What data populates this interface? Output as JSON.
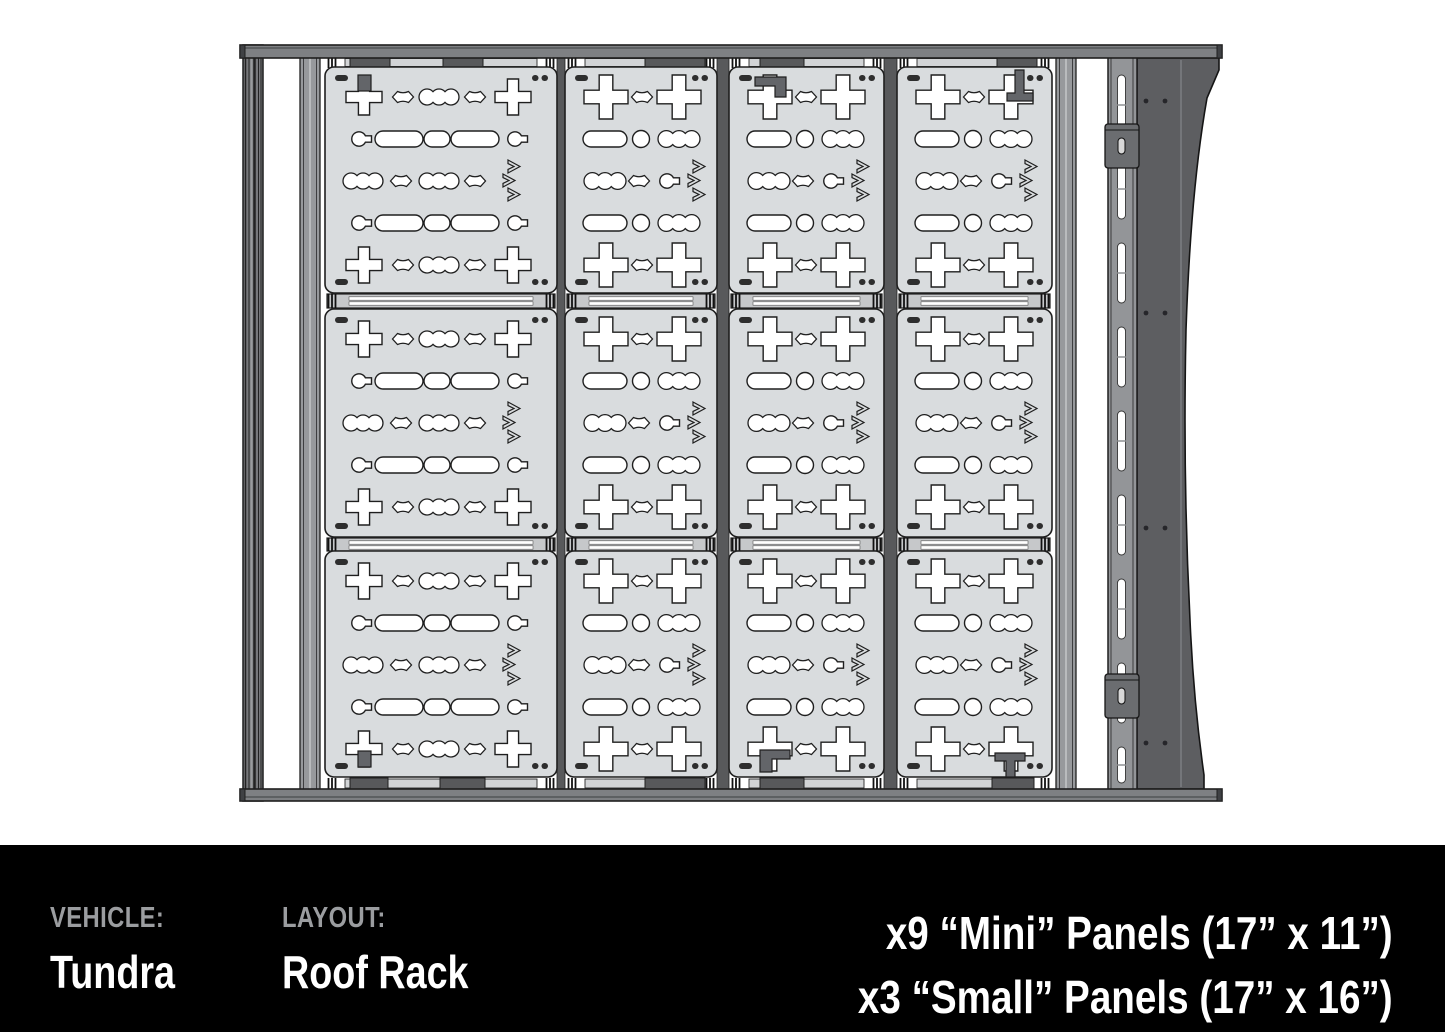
{
  "footer": {
    "vehicle_label": "VEHICLE:",
    "vehicle_value": "Tundra",
    "layout_label": "LAYOUT:",
    "layout_value": "Roof Rack",
    "panels_line1": "x9 “Mini” Panels (17” x 11”)",
    "panels_line2": "x3 “Small” Panels (17” x 16”)",
    "label_color": "#9b9da0",
    "value_color": "#ffffff",
    "bg_color": "#000000"
  },
  "diagram": {
    "canvas": {
      "w": 1445,
      "h": 845
    },
    "colors": {
      "ink": "#1f1f1f",
      "panel": "#d9dcde",
      "frame": "#7e8083",
      "frame_cap": "#3f4144",
      "rail": "#97999c",
      "outer_rail": "#77787b",
      "gap": "#58595b",
      "band": "#c6c8ca",
      "strip": "#d2d4d6",
      "slot_rail": "#939598",
      "fairing": "#5d5e61",
      "clamp": "#6b6d70",
      "bracket": "#636569",
      "screw": "#2e2e2e",
      "white": "#ffffff"
    },
    "top_bar": {
      "x": 240,
      "y": 45,
      "w": 982,
      "h": 13
    },
    "bottom_bar": {
      "x": 240,
      "y": 789,
      "w": 982,
      "h": 12
    },
    "outer_rail": {
      "x": 243,
      "y": 45,
      "w": 20,
      "h": 756
    },
    "inner_rails": [
      {
        "x": 300,
        "y": 57,
        "w": 20,
        "h": 733
      },
      {
        "x": 1056,
        "y": 57,
        "w": 20,
        "h": 733
      }
    ],
    "gap_strips": [
      {
        "x": 557,
        "w": 8
      },
      {
        "x": 717,
        "w": 12
      },
      {
        "x": 884,
        "w": 13
      }
    ],
    "gap_y": {
      "y": 58,
      "h": 731
    },
    "slotted_rail": {
      "x": 1108,
      "y": 57,
      "w": 29,
      "h": 733,
      "slot_x": 1117.5,
      "slot_w": 8,
      "slot_h": 60,
      "pitch": 84,
      "start": 75,
      "end": 783
    },
    "clamps": [
      {
        "x": 1105,
        "y": 124,
        "w": 34,
        "h": 44
      },
      {
        "x": 1105,
        "y": 674,
        "w": 34,
        "h": 44
      }
    ],
    "fairing": {
      "path": "M1137,58 L1219,58 L1219,70 L1207,98 C1196,160 1189,240 1186,330 C1184,420 1185,520 1190,620 C1193,690 1199,740 1204,775 L1204,789 L1137,789 Z",
      "fold_x": 1181,
      "holes": [
        [
          1146,
          101
        ],
        [
          1165,
          101
        ],
        [
          1146,
          313
        ],
        [
          1165,
          313
        ],
        [
          1146,
          528
        ],
        [
          1165,
          528
        ],
        [
          1146,
          743
        ],
        [
          1165,
          743
        ]
      ]
    },
    "columns": [
      {
        "x": 325,
        "w": 232,
        "type": "small"
      },
      {
        "x": 565,
        "w": 152,
        "type": "mini"
      },
      {
        "x": 729,
        "w": 155,
        "type": "mini"
      },
      {
        "x": 897,
        "w": 155,
        "type": "mini"
      }
    ],
    "rows": [
      {
        "y": 67,
        "h": 226
      },
      {
        "y": 309,
        "h": 228
      },
      {
        "y": 551,
        "h": 226
      }
    ],
    "bands": [
      {
        "y": 294,
        "h": 14
      },
      {
        "y": 538,
        "h": 13
      }
    ],
    "strips": [
      {
        "y": 58.5,
        "h": 8
      },
      {
        "y": 779,
        "h": 9
      }
    ],
    "top_tabs": [
      {
        "col": 0,
        "x": 25,
        "w": 40
      },
      {
        "col": 0,
        "x": 118,
        "w": 40
      },
      {
        "col": 1,
        "x": 80,
        "w": 60
      },
      {
        "col": 2,
        "x": 31,
        "w": 44
      },
      {
        "col": 3,
        "x": 100,
        "w": 40
      }
    ],
    "bottom_tabs": [
      {
        "col": 0,
        "x": 25,
        "w": 38
      },
      {
        "col": 0,
        "x": 115,
        "w": 45
      },
      {
        "col": 1,
        "x": 80,
        "w": 60
      },
      {
        "col": 2,
        "x": 31,
        "w": 44
      },
      {
        "col": 3,
        "x": 95,
        "w": 42
      }
    ],
    "row_ys": [
      30,
      72,
      114,
      156,
      198
    ],
    "panel_types": {
      "small": {
        "rows": [
          [
            [
              "plus",
              39,
              36
            ],
            [
              "diamond",
              78
            ],
            [
              "trilobe",
              114,
              40
            ],
            [
              "diamond",
              150
            ],
            [
              "plus",
              188,
              36
            ]
          ],
          [
            [
              "keyhole",
              34
            ],
            [
              "pill",
              74,
              48
            ],
            [
              "pill",
              112,
              26
            ],
            [
              "pill",
              150,
              48
            ],
            [
              "keyhole",
              190
            ]
          ],
          [
            [
              "trilobe",
              38,
              40
            ],
            [
              "diamond",
              76
            ],
            [
              "trilobe",
              114,
              40
            ],
            [
              "diamond",
              150
            ],
            [
              "logo",
              190
            ]
          ],
          [
            [
              "keyhole",
              34
            ],
            [
              "pill",
              74,
              48
            ],
            [
              "pill",
              112,
              26
            ],
            [
              "pill",
              150,
              48
            ],
            [
              "keyhole",
              190
            ]
          ],
          [
            [
              "plus",
              39,
              36
            ],
            [
              "diamond",
              78
            ],
            [
              "trilobe",
              114,
              40
            ],
            [
              "diamond",
              150
            ],
            [
              "plus",
              188,
              36
            ]
          ]
        ]
      },
      "mini": {
        "rows": [
          [
            [
              "plus",
              41,
              44
            ],
            [
              "diamond",
              77
            ],
            [
              "plus",
              114,
              44
            ]
          ],
          [
            [
              "pill",
              40,
              44
            ],
            [
              "circle",
              76
            ],
            [
              "trilobe",
              114,
              42
            ]
          ],
          [
            [
              "trilobe",
              40,
              42
            ],
            [
              "diamond",
              74
            ],
            [
              "keyhole",
              102
            ],
            [
              "logo",
              135
            ]
          ],
          [
            [
              "pill",
              40,
              44
            ],
            [
              "circle",
              76
            ],
            [
              "trilobe",
              114,
              42
            ]
          ],
          [
            [
              "plus",
              41,
              44
            ],
            [
              "diamond",
              77
            ],
            [
              "plus",
              114,
              44
            ]
          ]
        ]
      }
    },
    "brackets": [
      {
        "row": 0,
        "col": 0,
        "shape": "rect",
        "x": 33,
        "y": 8,
        "w": 13,
        "h": 16
      },
      {
        "row": 2,
        "col": 0,
        "shape": "rect",
        "x": 33,
        "y": 200,
        "w": 13,
        "h": 16
      },
      {
        "row": 0,
        "col": 2,
        "shape": "poly",
        "pts": [
          [
            26,
            10
          ],
          [
            57,
            10
          ],
          [
            57,
            30
          ],
          [
            46,
            30
          ],
          [
            46,
            19
          ],
          [
            26,
            19
          ]
        ]
      },
      {
        "row": 2,
        "col": 2,
        "shape": "poly",
        "pts": [
          [
            31,
            199
          ],
          [
            61,
            199
          ],
          [
            61,
            208
          ],
          [
            43,
            208
          ],
          [
            43,
            221
          ],
          [
            31,
            221
          ]
        ]
      },
      {
        "row": 0,
        "col": 3,
        "shape": "poly",
        "pts": [
          [
            118,
            3
          ],
          [
            127,
            3
          ],
          [
            127,
            26
          ],
          [
            136,
            26
          ],
          [
            136,
            34
          ],
          [
            110,
            34
          ],
          [
            110,
            26
          ],
          [
            118,
            26
          ]
        ]
      },
      {
        "row": 2,
        "col": 3,
        "shape": "poly",
        "pts": [
          [
            98,
            202
          ],
          [
            128,
            202
          ],
          [
            128,
            210
          ],
          [
            118,
            210
          ],
          [
            118,
            226
          ],
          [
            109,
            226
          ],
          [
            109,
            210
          ],
          [
            98,
            210
          ]
        ]
      }
    ]
  }
}
